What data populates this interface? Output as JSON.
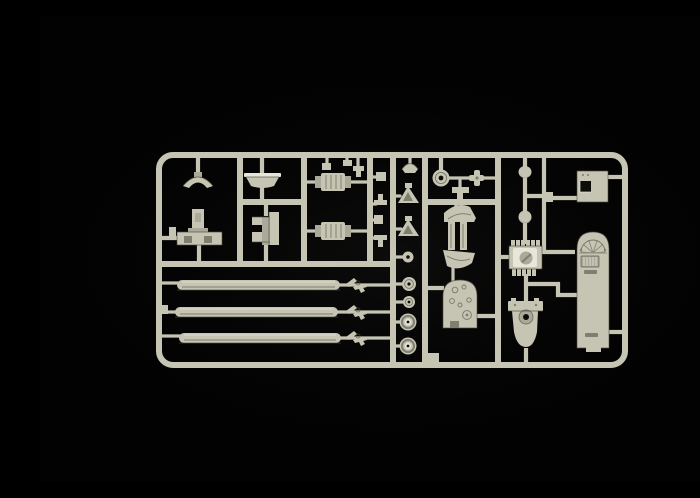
{
  "scene": {
    "type": "product-photo",
    "subject": "Injection-molded plastic model kit sprue (parts tree) with helicopter parts, photographed on a black background",
    "background": "black",
    "text_content": "none"
  },
  "colors": {
    "background": "#020202",
    "glow": "#c8c8be",
    "plastic": "#c6c5b4",
    "plastic_highlight": "#e7e6d8",
    "plastic_mid": "#aaa99a",
    "plastic_shadow": "#7f7e6f",
    "plastic_dark": "#4c4b41",
    "hole": "#0d0d08"
  },
  "sprue": {
    "frame": "rounded-rectangle runner frame with internal vertical and horizontal runners",
    "sections": [
      "cockpit fittings grid (top left)",
      "exhaust and small fittings (top center)",
      "small parts and wheels column (center)",
      "floor panels and instrument panel (center)",
      "engine and gearbox (center right)",
      "access hatch and cabin door (right)",
      "rotor blade rack of three blades (bottom left)"
    ],
    "parts": [
      {
        "name": "canopy bow",
        "qty": 1
      },
      {
        "name": "instrument coaming tray",
        "qty": 1
      },
      {
        "name": "control pedestal with floor base",
        "qty": 1
      },
      {
        "name": "crew seat",
        "qty": 1
      },
      {
        "name": "exhaust silencer",
        "qty": 2
      },
      {
        "name": "small clips and fittings",
        "qty": 7
      },
      {
        "name": "rotor head cap",
        "qty": 1
      },
      {
        "name": "swashplate triangle link",
        "qty": 2
      },
      {
        "name": "linkage ball",
        "qty": 1
      },
      {
        "name": "wheel",
        "qty": 4
      },
      {
        "name": "pulley disc",
        "qty": 1
      },
      {
        "name": "cross shaft",
        "qty": 1
      },
      {
        "name": "tee bracket",
        "qty": 1
      },
      {
        "name": "curved floor panel",
        "qty": 2
      },
      {
        "name": "door rail strip",
        "qty": 2
      },
      {
        "name": "instrument panel bulkhead",
        "qty": 1
      },
      {
        "name": "intake ball fitting",
        "qty": 2
      },
      {
        "name": "ribbed engine block",
        "qty": 1
      },
      {
        "name": "gearbox housing",
        "qty": 1
      },
      {
        "name": "square access hatch",
        "qty": 1
      },
      {
        "name": "cabin door with vent grille",
        "qty": 1
      },
      {
        "name": "main rotor blade",
        "qty": 3
      },
      {
        "name": "rotor scissor link",
        "qty": 3
      }
    ]
  }
}
